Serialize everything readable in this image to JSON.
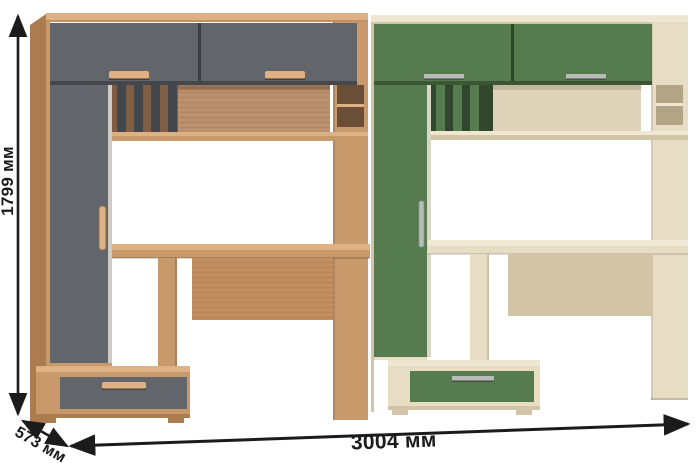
{
  "dimensions": {
    "height_label": "1799 мм",
    "depth_label": "573 мм",
    "width_label": "3004 мм"
  },
  "colors": {
    "wood": "#c8996a",
    "wood_light": "#ddb183",
    "wood_dark": "#ab7c50",
    "wood_back": "#bb9170",
    "graphite": "#62656a",
    "graphite_dark": "#43464b",
    "green": "#567b4f",
    "green_dark": "#31482c",
    "cream": "#e7dcc4",
    "cream_dark": "#d2c4a7",
    "cream_back": "#ded2b9",
    "metal": "#b8bcb8",
    "dim_line": "#1b1b1b"
  }
}
